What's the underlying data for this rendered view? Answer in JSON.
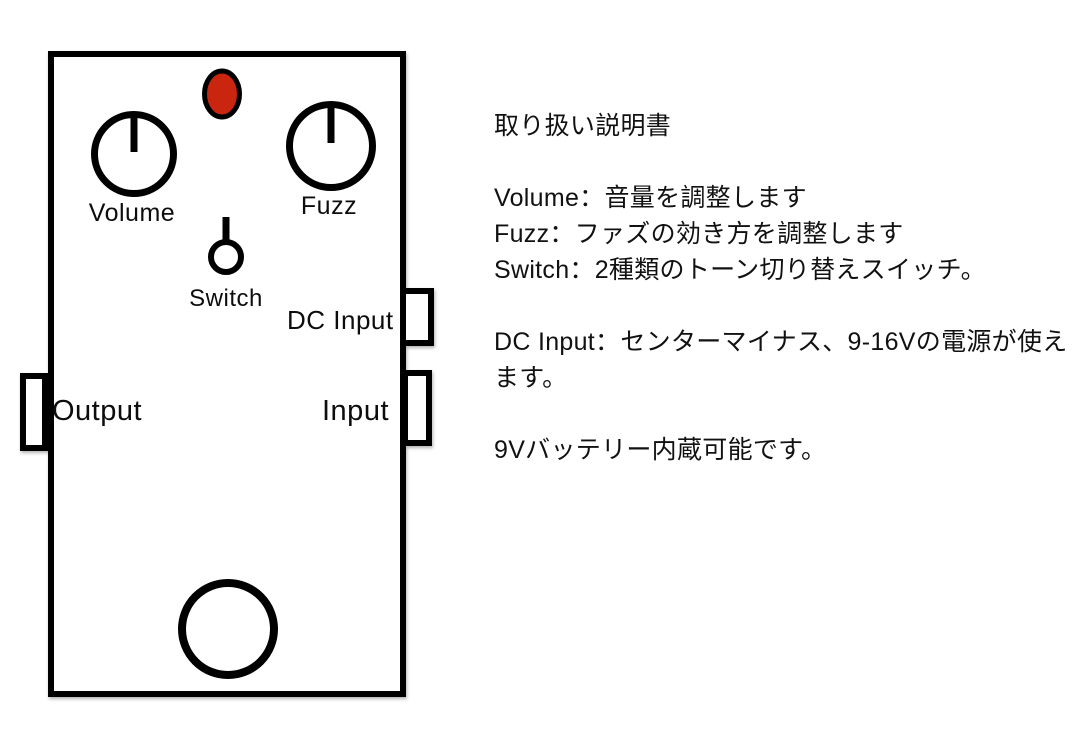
{
  "page": {
    "background_color": "#ffffff",
    "outline_color": "#000000"
  },
  "pedal": {
    "led_color": "#c9250f",
    "labels": {
      "volume": "Volume",
      "fuzz": "Fuzz",
      "switch": "Switch",
      "dc_input": "DC Input",
      "output": "Output",
      "input": "Input"
    }
  },
  "instructions": {
    "title": "取り扱い説明書",
    "lines": [
      "取り扱い説明書",
      "",
      "Volume：音量を調整します",
      "Fuzz：ファズの効き方を調整します",
      "Switch：2種類のトーン切り替えスイッチ。",
      "",
      "DC Input：センターマイナス、9-16Vの電源が使え",
      "ます。",
      "",
      "9Vバッテリー内蔵可能です。"
    ]
  }
}
